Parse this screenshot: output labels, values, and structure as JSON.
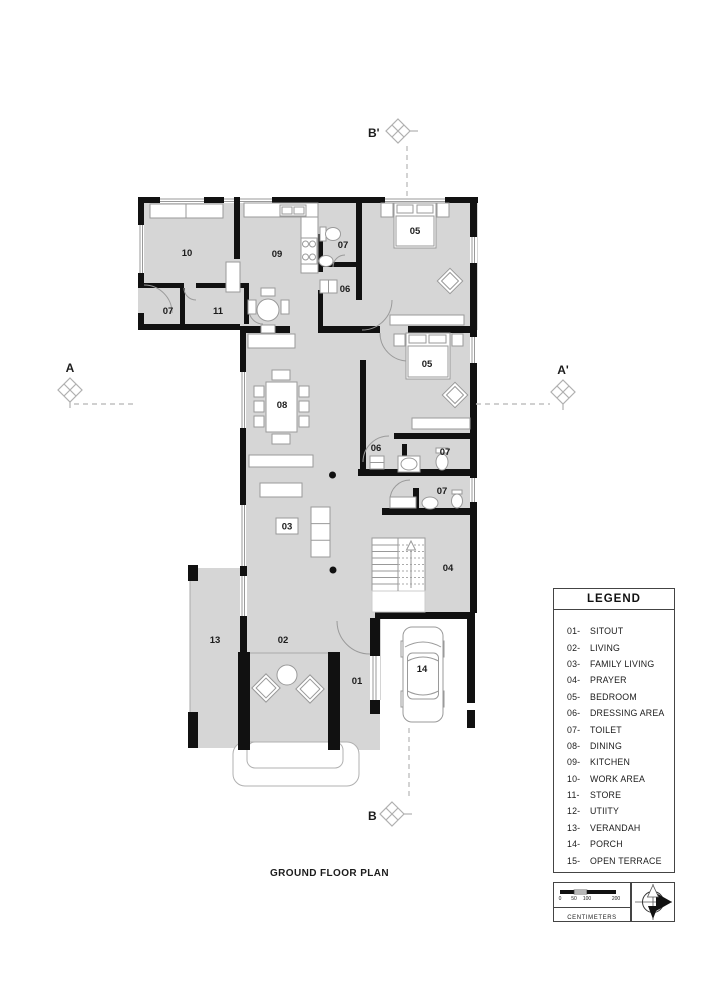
{
  "title": "GROUND FLOOR PLAN",
  "markers": {
    "a": "A",
    "a_prime": "A'",
    "b": "B",
    "b_prime": "B'"
  },
  "rooms": {
    "r10": "10",
    "r09": "09",
    "r07a": "07",
    "r11": "11",
    "r07b": "07",
    "r06a": "06",
    "r05a": "05",
    "r08": "08",
    "r05b": "05",
    "r06b": "06",
    "r07c": "07",
    "r07d": "07",
    "r03": "03",
    "r04": "04",
    "r13": "13",
    "r02": "02",
    "r01": "01",
    "r14": "14"
  },
  "legend": {
    "title": "LEGEND",
    "items": [
      {
        "num": "01-",
        "label": "SITOUT"
      },
      {
        "num": "02-",
        "label": "LIVING"
      },
      {
        "num": "03-",
        "label": "FAMILY LIVING"
      },
      {
        "num": "04-",
        "label": "PRAYER"
      },
      {
        "num": "05-",
        "label": "BEDROOM"
      },
      {
        "num": "06-",
        "label": "DRESSING AREA"
      },
      {
        "num": "07-",
        "label": "TOILET"
      },
      {
        "num": "08-",
        "label": "DINING"
      },
      {
        "num": "09-",
        "label": "KITCHEN"
      },
      {
        "num": "10-",
        "label": "WORK AREA"
      },
      {
        "num": "11-",
        "label": "STORE"
      },
      {
        "num": "12-",
        "label": "UTIITY"
      },
      {
        "num": "13-",
        "label": "VERANDAH"
      },
      {
        "num": "14-",
        "label": "PORCH"
      },
      {
        "num": "15-",
        "label": "OPEN TERRACE"
      }
    ]
  },
  "scalebar": {
    "ticks": [
      "0",
      "50",
      "100",
      "200"
    ],
    "unit": "CENTIMETERS"
  },
  "colors": {
    "floor": "#d6d6d6",
    "wall": "#111111",
    "furniture": "#9a9a9a"
  }
}
